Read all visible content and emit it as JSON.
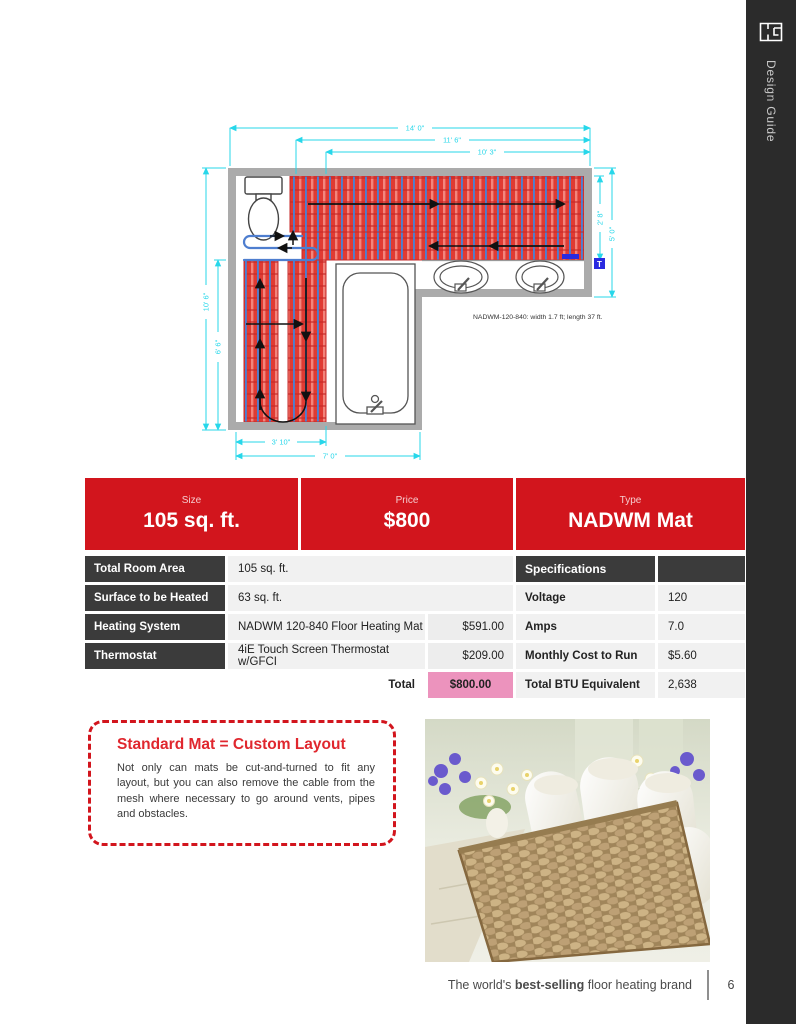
{
  "sidebar": {
    "label": "Design Guide"
  },
  "plan": {
    "dims": {
      "top": [
        "14' 0\"",
        "11' 6\"",
        "10' 3\""
      ],
      "left": [
        "10' 6\"",
        "6' 6\""
      ],
      "right": [
        "2' 8\"",
        "5' 0\""
      ],
      "bottom": [
        "3' 10\"",
        "7' 0\""
      ]
    },
    "mat_label": "NADWM-120-840:  width 1.7 ft;  length 37 ft.",
    "thermostat_label": "T"
  },
  "summary": {
    "size": {
      "label": "Size",
      "value": "105 sq. ft."
    },
    "price": {
      "label": "Price",
      "value": "$800"
    },
    "type": {
      "label": "Type",
      "value": "NADWM Mat"
    }
  },
  "details": {
    "rows": [
      {
        "label": "Total Room Area",
        "value": "105 sq. ft."
      },
      {
        "label": "Surface to be Heated",
        "value": "63 sq. ft."
      },
      {
        "label": "Heating System",
        "value": "NADWM 120-840 Floor Heating Mat",
        "price": "$591.00"
      },
      {
        "label": "Thermostat",
        "value": "4iE Touch Screen Thermostat w/GFCI",
        "price": "$209.00"
      }
    ],
    "total_label": "Total",
    "total_value": "$800.00"
  },
  "specs": {
    "header": "Specifications",
    "rows": [
      {
        "label": "Voltage",
        "value": "120"
      },
      {
        "label": "Amps",
        "value": "7.0"
      },
      {
        "label": "Monthly Cost to Run",
        "value": "$5.60"
      },
      {
        "label": "Total BTU Equivalent",
        "value": "2,638"
      }
    ]
  },
  "callout": {
    "title": "Standard Mat = Custom Layout",
    "body": "Not only can mats be cut-and-turned to fit any layout, but you can also remove the cable from the mesh where necessary to go around vents, pipes and obstacles."
  },
  "footer": {
    "text_prefix": "The world's ",
    "text_bold": "best-selling",
    "text_suffix": " floor heating brand",
    "page": "6"
  },
  "colors": {
    "accent_red": "#d2151d",
    "dark_cell": "#3b3b3b",
    "pink_total": "#ec93bd",
    "dim_cyan": "#27d7ea",
    "mat_red": "#e03b33",
    "cable_blue": "#4e7ecf"
  }
}
